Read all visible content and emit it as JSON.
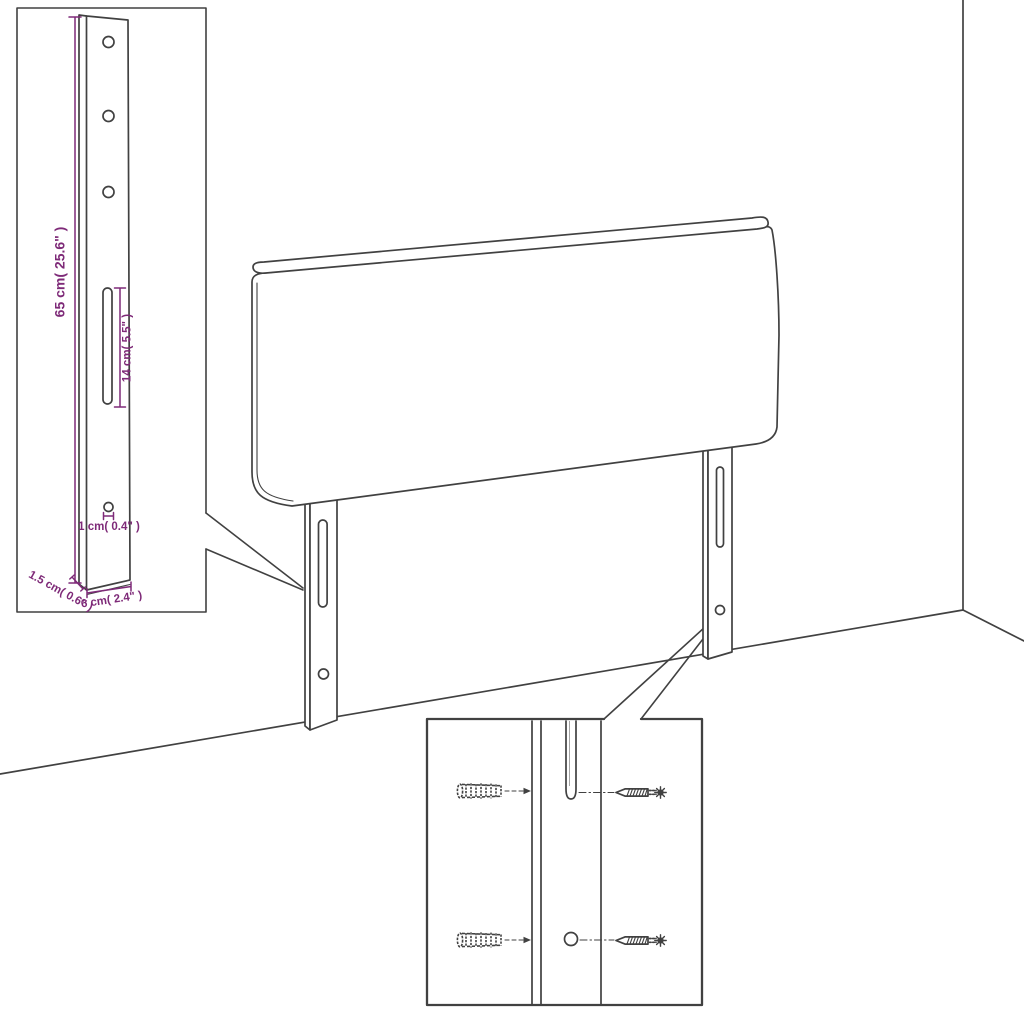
{
  "colors": {
    "line": "#414141",
    "dimension": "#7e2a78",
    "background": "#ffffff"
  },
  "insets": {
    "bracket_detail": {
      "height_label": "65 cm( 25.6\" )",
      "slot_label": "14 cm( 5.5\" )",
      "hole_label": "1 cm( 0.4\" )",
      "width_label": "6 cm( 2.4\" )",
      "depth_label": "1.5 cm( 0.6\" )"
    }
  }
}
